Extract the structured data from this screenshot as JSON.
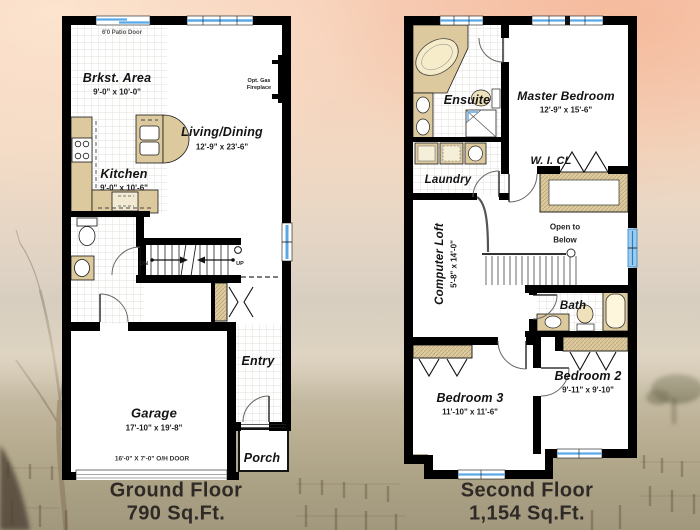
{
  "colors": {
    "wall": "#000000",
    "counter_tan": "#dcc99e",
    "window_blue": "#5aa9e6",
    "tile_line": "#d9d5cc",
    "caption_text": "#2f2a26",
    "sky_top": "#f7cfb8",
    "ground_bottom": "#a1987e"
  },
  "ground_floor": {
    "caption_line1": "Ground Floor",
    "caption_line2": "790 Sq.Ft.",
    "rooms": {
      "brkst": {
        "name": "Brkst. Area",
        "dims": "9'-0\" x 10'-0\""
      },
      "kitchen": {
        "name": "Kitchen",
        "dims": "9'-0\" x 10'-6\""
      },
      "living": {
        "name": "Living/Dining",
        "dims": "12'-9\" x 23'-6\""
      },
      "garage": {
        "name": "Garage",
        "dims": "17'-10\" x 19'-8\""
      },
      "entry": {
        "name": "Entry"
      },
      "porch": {
        "name": "Porch"
      }
    },
    "notes": {
      "patio_door": "6'0 Patio Door",
      "fireplace_line1": "Opt. Gas",
      "fireplace_line2": "Fireplace",
      "down": "DN",
      "up": "UP",
      "overhead_door": "16'-0\" X 7'-0\" O/H DOOR"
    }
  },
  "second_floor": {
    "caption_line1": "Second Floor",
    "caption_line2": "1,154 Sq.Ft.",
    "rooms": {
      "ensuite": {
        "name": "Ensuite"
      },
      "master": {
        "name": "Master Bedroom",
        "dims": "12'-9\" x 15'-6\""
      },
      "wicl": {
        "name": "W. I. CL"
      },
      "laundry": {
        "name": "Laundry"
      },
      "loft": {
        "name": "Computer Loft",
        "dims": "5'-8\" x 14'-0\""
      },
      "bath": {
        "name": "Bath"
      },
      "bedroom3": {
        "name": "Bedroom 3",
        "dims": "11'-10\" x 11'-6\""
      },
      "bedroom2": {
        "name": "Bedroom 2",
        "dims": "9'-11\" x 9'-10\""
      }
    },
    "notes": {
      "open_below_line1": "Open to",
      "open_below_line2": "Below"
    }
  }
}
